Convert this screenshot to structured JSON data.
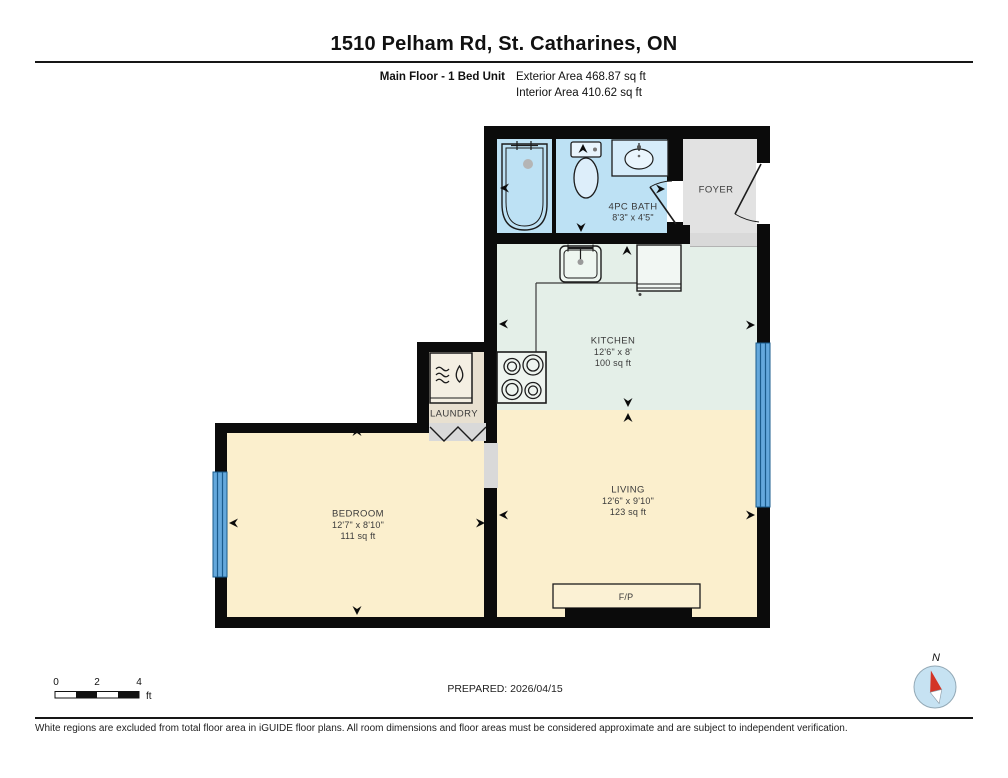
{
  "header": {
    "title": "1510 Pelham Rd, St. Catharines, ON",
    "unit_label": "Main Floor - 1 Bed Unit",
    "exterior_area": "Exterior Area 468.87 sq ft",
    "interior_area": "Interior Area 410.62 sq ft"
  },
  "rooms": {
    "bath": {
      "name": "4PC BATH",
      "dims": "8'3\" x 4'5\""
    },
    "foyer": {
      "name": "FOYER"
    },
    "kitchen": {
      "name": "KITCHEN",
      "dims": "12'6\" x 8'",
      "area": "100 sq ft"
    },
    "laundry": {
      "name": "LAUNDRY"
    },
    "bedroom": {
      "name": "BEDROOM",
      "dims": "12'7\" x 8'10\"",
      "area": "111 sq ft"
    },
    "living": {
      "name": "LIVING",
      "dims": "12'6\" x 9'10\"",
      "area": "123 sq ft"
    },
    "fireplace": {
      "name": "F/P"
    }
  },
  "footer": {
    "prepared": "PREPARED: 2026/04/15",
    "scale_ticks": [
      "0",
      "2",
      "4"
    ],
    "scale_unit": "ft",
    "compass_label": "N",
    "disclaimer": "White regions are excluded from total floor area in iGUIDE floor plans. All room dimensions and floor areas must be considered approximate and are subject to independent verification."
  },
  "colors": {
    "wall": "#0b0b0b",
    "bath": "#bde1f4",
    "foyer": "#e2e2e2",
    "threshold": "#d9d9d9",
    "kitchen": "#e4efe8",
    "cream": "#fbefcd",
    "laundry": "#e8e0d0",
    "window": "#64a8dc",
    "window_line": "#1a5b8c",
    "compass_red": "#d33426",
    "compass_face": "#c6e2f2"
  }
}
